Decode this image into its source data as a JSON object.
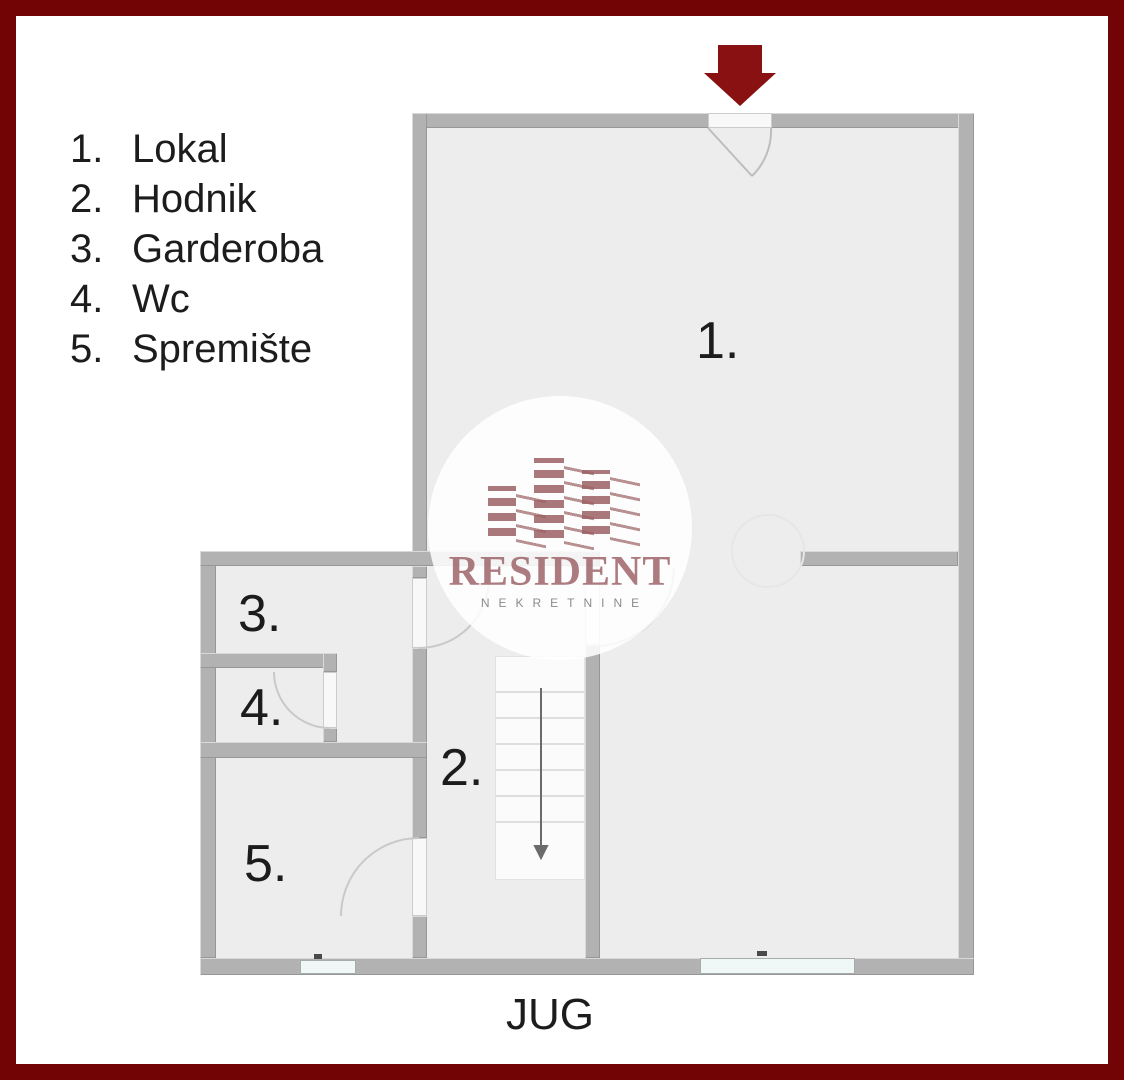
{
  "colors": {
    "frame": "#730405",
    "arrow": "#891112",
    "wall": "#b2b2b2",
    "floor": "#ededed",
    "window": "#f0f7f7",
    "brand": "#9c6164"
  },
  "legend": {
    "items": [
      {
        "num": "1.",
        "label": "Lokal"
      },
      {
        "num": "2.",
        "label": "Hodnik"
      },
      {
        "num": "3.",
        "label": "Garderoba"
      },
      {
        "num": "4.",
        "label": "Wc"
      },
      {
        "num": "5.",
        "label": "Spremište"
      }
    ]
  },
  "floorplan": {
    "rooms": [
      {
        "label": "1."
      },
      {
        "label": "2."
      },
      {
        "label": "3."
      },
      {
        "label": "4."
      },
      {
        "label": "5."
      }
    ],
    "orientation_label": "JUG",
    "entrance_arrow": {
      "direction": "down"
    },
    "stairs_arrow": {
      "direction": "down"
    }
  },
  "watermark": {
    "brand": "RESIDENT",
    "subtitle": "NEKRETNINE"
  }
}
